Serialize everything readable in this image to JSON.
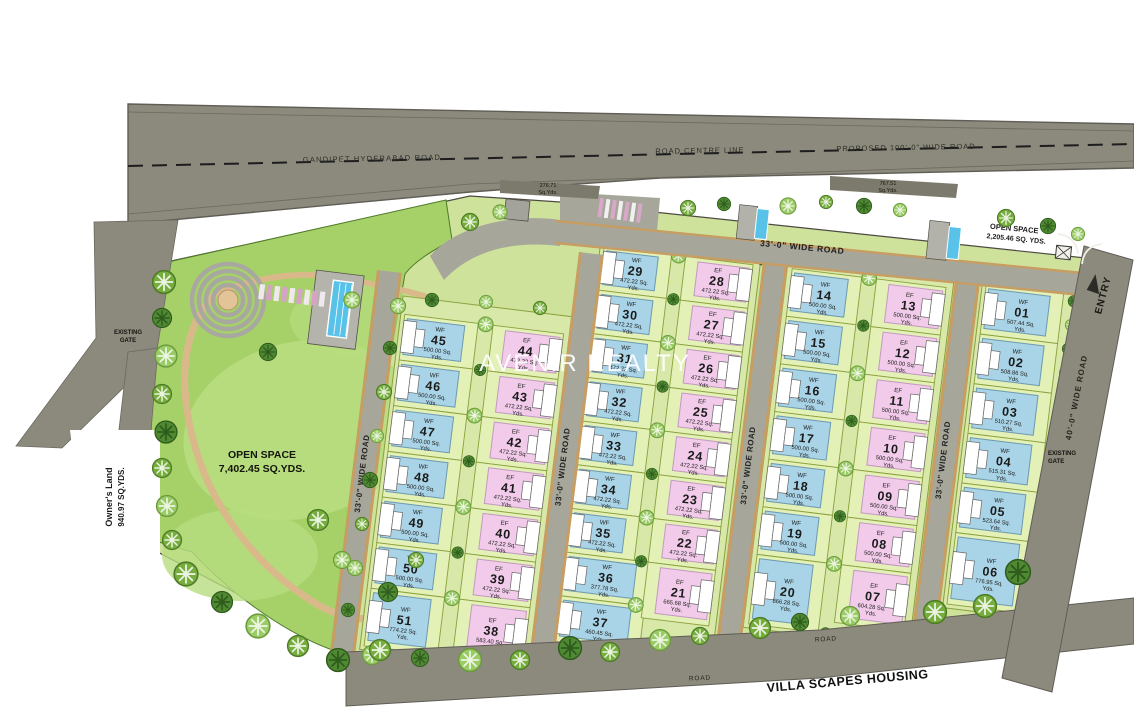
{
  "labels": {
    "main_road": "GANDIPET HYDERABAD ROAD",
    "road_centre_line": "ROAD CENTRE LINE",
    "proposed_road": "PROPOSED 100'-0\" WIDE ROAD",
    "internal_road": "33'-0\" WIDE ROAD",
    "east_road": "40'-0\" WIDE ROAD",
    "entry": "ENTRY",
    "existing_gate": "EXISTING GATE",
    "road": "ROAD",
    "neighbor": "VILLA SCAPES HOUSING",
    "watermark": "AVENIR REALTY",
    "wedge_left": [
      "276.71",
      "Sq.Yds."
    ],
    "wedge_right": [
      "767.51",
      "Sq.Yds."
    ],
    "open_space_park": [
      "OPEN SPACE",
      "7,402.45 SQ.YDS."
    ],
    "open_space_top": [
      "OPEN SPACE",
      "2,205.46 SQ. YDS."
    ],
    "owners_land": [
      "Owner's Land",
      "940.97 SQ.YDS."
    ],
    "units": [
      "Sq.",
      "Yds."
    ]
  },
  "colors": {
    "wf_plot": "#a9d3e6",
    "wf_stroke": "#6d9ab0",
    "ef_plot": "#f1cbe9",
    "ef_stroke": "#c29ac0",
    "yard": "#e3f0b6",
    "yard_line": "#8aa03c",
    "strip_base": "#d7e8a8",
    "road": "#a6a69b",
    "road_edge": "#c79d62",
    "main_road": "#8c8a7d",
    "park": "#a6d168",
    "park_light": "#b8dd7f",
    "pool": "#58c2e8",
    "wedge": "#7c7a6c"
  },
  "strips": [
    {
      "id": "A",
      "wf": [
        "45",
        "46",
        "47",
        "48",
        "49",
        "50",
        "51"
      ],
      "ef": [
        "44",
        "43",
        "42",
        "41",
        "40",
        "39",
        "38"
      ]
    },
    {
      "id": "B",
      "wf": [
        "29",
        "30",
        "31",
        "32",
        "33",
        "34",
        "35",
        "36",
        "37"
      ],
      "ef": [
        "28",
        "27",
        "26",
        "25",
        "24",
        "23",
        "22",
        "21"
      ]
    },
    {
      "id": "C",
      "wf": [
        "14",
        "15",
        "16",
        "17",
        "18",
        "19",
        "20"
      ],
      "ef": [
        "13",
        "12",
        "11",
        "10",
        "09",
        "08",
        "07"
      ]
    },
    {
      "id": "D",
      "wf": [
        "01",
        "02",
        "03",
        "04",
        "05",
        "06"
      ],
      "ef": []
    }
  ],
  "plots": [
    {
      "no": "01",
      "facing": "WF",
      "area": "507.44"
    },
    {
      "no": "02",
      "facing": "WF",
      "area": "508.86"
    },
    {
      "no": "03",
      "facing": "WF",
      "area": "510.27"
    },
    {
      "no": "04",
      "facing": "WF",
      "area": "515.31"
    },
    {
      "no": "05",
      "facing": "WF",
      "area": "523.64"
    },
    {
      "no": "06",
      "facing": "WF",
      "area": "776.95"
    },
    {
      "no": "07",
      "facing": "EF",
      "area": "604.28"
    },
    {
      "no": "08",
      "facing": "EF",
      "area": "500.00"
    },
    {
      "no": "09",
      "facing": "EF",
      "area": "500.00"
    },
    {
      "no": "10",
      "facing": "EF",
      "area": "500.00"
    },
    {
      "no": "11",
      "facing": "EF",
      "area": "500.00"
    },
    {
      "no": "12",
      "facing": "EF",
      "area": "500.00"
    },
    {
      "no": "13",
      "facing": "EF",
      "area": "500.00"
    },
    {
      "no": "14",
      "facing": "WF",
      "area": "500.00"
    },
    {
      "no": "15",
      "facing": "WF",
      "area": "500.00"
    },
    {
      "no": "16",
      "facing": "WF",
      "area": "500.00"
    },
    {
      "no": "17",
      "facing": "WF",
      "area": "500.00"
    },
    {
      "no": "18",
      "facing": "WF",
      "area": "500.00"
    },
    {
      "no": "19",
      "facing": "WF",
      "area": "500.00"
    },
    {
      "no": "20",
      "facing": "WF",
      "area": "866.28"
    },
    {
      "no": "21",
      "facing": "EF",
      "area": "665.68"
    },
    {
      "no": "22",
      "facing": "EF",
      "area": "472.22"
    },
    {
      "no": "23",
      "facing": "EF",
      "area": "472.22"
    },
    {
      "no": "24",
      "facing": "EF",
      "area": "472.22"
    },
    {
      "no": "25",
      "facing": "EF",
      "area": "472.22"
    },
    {
      "no": "26",
      "facing": "EF",
      "area": "472.22"
    },
    {
      "no": "27",
      "facing": "EF",
      "area": "472.22"
    },
    {
      "no": "28",
      "facing": "EF",
      "area": "472.22"
    },
    {
      "no": "29",
      "facing": "WF",
      "area": "472.22"
    },
    {
      "no": "30",
      "facing": "WF",
      "area": "472.22"
    },
    {
      "no": "31",
      "facing": "WF",
      "area": "472.22"
    },
    {
      "no": "32",
      "facing": "WF",
      "area": "472.22"
    },
    {
      "no": "33",
      "facing": "WF",
      "area": "472.22"
    },
    {
      "no": "34",
      "facing": "WF",
      "area": "472.22"
    },
    {
      "no": "35",
      "facing": "WF",
      "area": "472.22"
    },
    {
      "no": "36",
      "facing": "WF",
      "area": "377.78"
    },
    {
      "no": "37",
      "facing": "WF",
      "area": "460.45"
    },
    {
      "no": "38",
      "facing": "EF",
      "area": "583.40"
    },
    {
      "no": "39",
      "facing": "EF",
      "area": "472.22"
    },
    {
      "no": "40",
      "facing": "EF",
      "area": "472.22"
    },
    {
      "no": "41",
      "facing": "EF",
      "area": "472.22"
    },
    {
      "no": "42",
      "facing": "EF",
      "area": "472.22"
    },
    {
      "no": "43",
      "facing": "EF",
      "area": "472.22"
    },
    {
      "no": "44",
      "facing": "EF",
      "area": "472.22"
    },
    {
      "no": "45",
      "facing": "WF",
      "area": "500.00"
    },
    {
      "no": "46",
      "facing": "WF",
      "area": "500.00"
    },
    {
      "no": "47",
      "facing": "WF",
      "area": "500.00"
    },
    {
      "no": "48",
      "facing": "WF",
      "area": "500.00"
    },
    {
      "no": "49",
      "facing": "WF",
      "area": "500.00"
    },
    {
      "no": "50",
      "facing": "WF",
      "area": "500.00"
    },
    {
      "no": "51",
      "facing": "WF",
      "area": "774.22"
    }
  ]
}
